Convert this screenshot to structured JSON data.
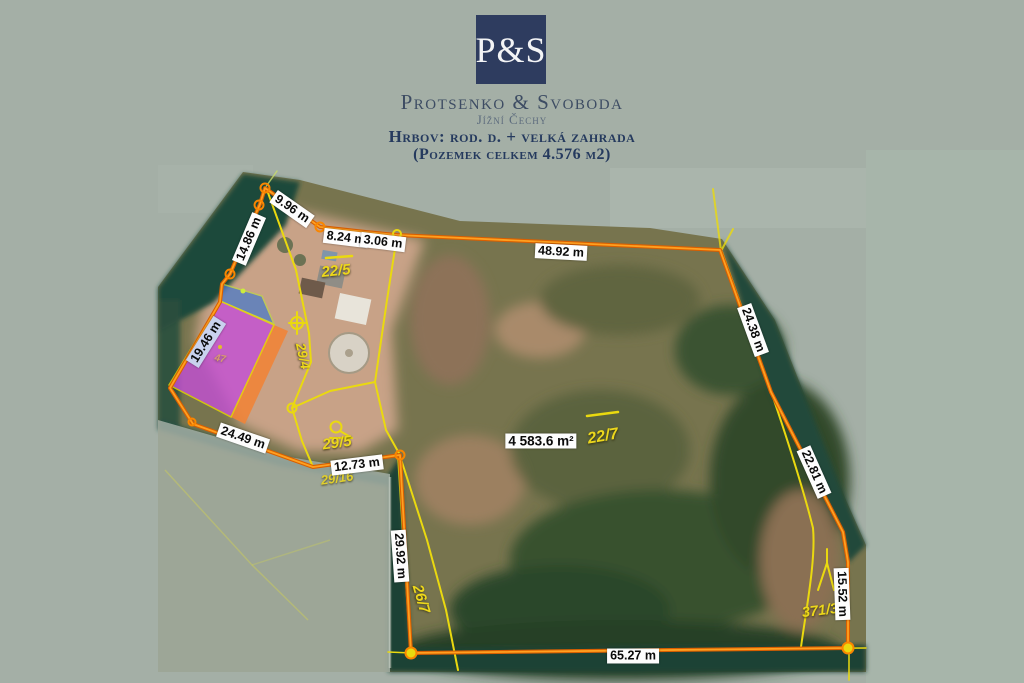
{
  "header": {
    "logo_text": "P&S",
    "company": "Protsenko & Svoboda",
    "region": "Jížní Čechy",
    "listing_title": "Hrbov: rod. d. + velká zahrada",
    "listing_subtitle": "(Pozemek celkem 4.576 m2)"
  },
  "map": {
    "area_label": "4 583.6 m²",
    "measurements": {
      "top_a": "9.96 m",
      "left_a": "14.86 m",
      "top_b": "8.24 m",
      "top_c": "3.06 m",
      "top_d": "48.92 m",
      "right_a": "24.38 m",
      "right_b": "22.81 m",
      "right_c": "15.52 m",
      "bottom_a": "65.27 m",
      "left_b": "29.92 m",
      "inner_a": "12.73 m",
      "inner_b": "24.49 m",
      "building_a": "19.46 m"
    },
    "parcel_numbers": {
      "p22_5": "22/5",
      "p29_4": "29/4",
      "p29_5": "29/5",
      "p29_16": "29/16",
      "p22_7": "22/7",
      "p26_7": "26/7",
      "p371_3": "371/3",
      "p47": "47"
    },
    "icons": {
      "survey_marker": "circle-with-stem",
      "boundary_vertex": "orange-ring",
      "peak_symbol": "zigzag-arrow"
    },
    "colors": {
      "background": "#a4afa6",
      "boundary_orange": "#f98600",
      "cadastral_yellow": "#ead90f",
      "building_highlight": "#c44fd6",
      "roof_highlight": "#4b7ac8",
      "logo_navy": "#2e3c5f",
      "header_text_navy": "#253a5e"
    }
  }
}
